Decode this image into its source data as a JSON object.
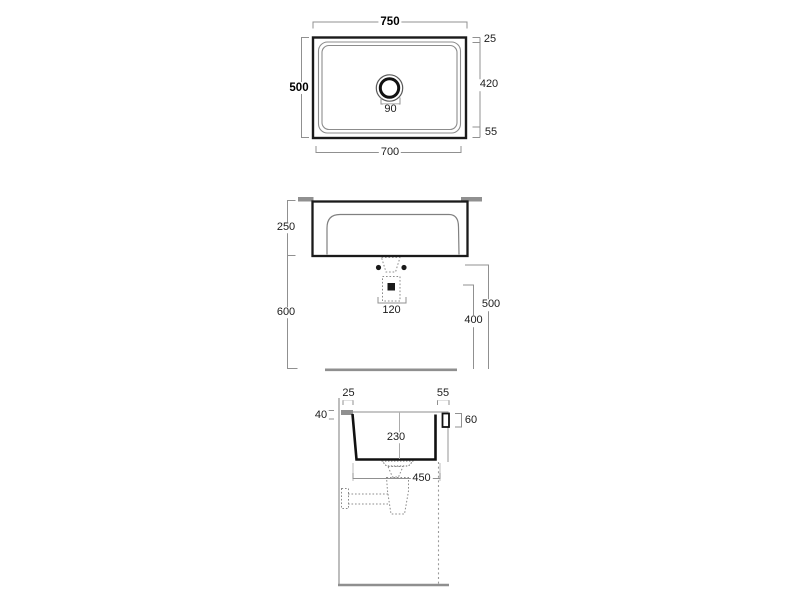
{
  "drawing": {
    "type": "sink-technical-drawing",
    "views": [
      "plan",
      "front-elevation",
      "side-section"
    ]
  },
  "views": {
    "plan": {
      "overall_width": "750",
      "overall_depth": "500",
      "rim_back": "25",
      "bowl_depth": "420",
      "rim_front": "55",
      "bowl_width": "700",
      "drain_diameter": "90"
    },
    "front": {
      "body_height": "250",
      "clearance_below": "600",
      "waste_width": "120",
      "fixing_height": "500",
      "drain_height": "400"
    },
    "section": {
      "back_offset": "25",
      "front_rim": "55",
      "bracket_height": "40",
      "apron_height": "60",
      "bowl_inner_depth": "230",
      "bowl_base_width": "450"
    }
  },
  "colors": {
    "object_line": "#1a1a1a",
    "secondary_line": "#8c8c8c",
    "dimension_line": "#909090",
    "bracket_fill": "#909090",
    "text": "#1c1c1c",
    "background": "#ffffff"
  }
}
